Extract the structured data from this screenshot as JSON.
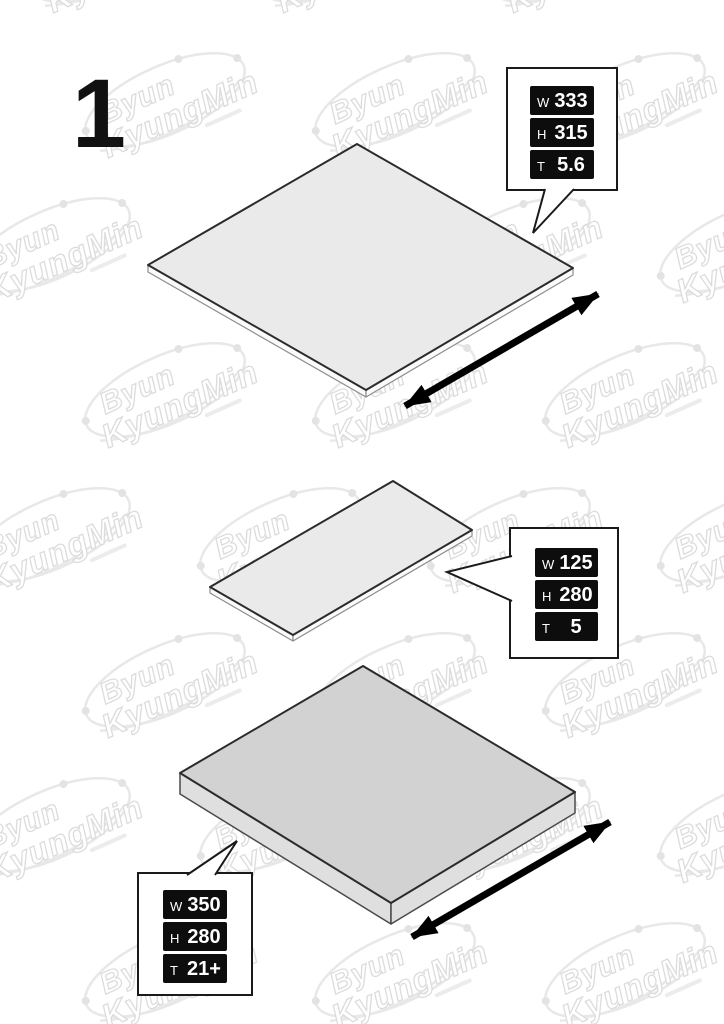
{
  "step_number": "1",
  "watermark": {
    "line1": "Byun",
    "line2": "KyungMin"
  },
  "callouts": [
    {
      "panel": "panel-1",
      "rows": [
        {
          "label": "W",
          "value": "333"
        },
        {
          "label": "H",
          "value": "315"
        },
        {
          "label": "T",
          "value": "5.6"
        }
      ]
    },
    {
      "panel": "panel-2",
      "rows": [
        {
          "label": "W",
          "value": "125"
        },
        {
          "label": "H",
          "value": "280"
        },
        {
          "label": "T",
          "value": "5"
        }
      ]
    },
    {
      "panel": "panel-3",
      "rows": [
        {
          "label": "W",
          "value": "350"
        },
        {
          "label": "H",
          "value": "280"
        },
        {
          "label": "T",
          "value": "21+"
        }
      ]
    }
  ],
  "colors": {
    "pill_bg": "#0d0d0d",
    "pill_text": "#ffffff",
    "panel_light_top": "#eaeaea",
    "panel_dark_top": "#d2d2d2",
    "outline": "#2b2b2b",
    "watermark": "#e6e6e6"
  }
}
